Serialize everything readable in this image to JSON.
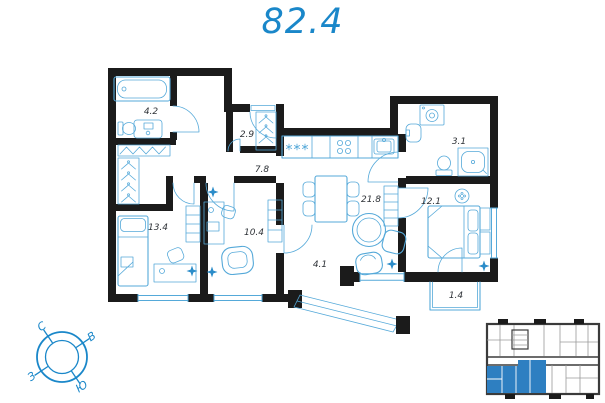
{
  "title": "82.4",
  "colors": {
    "accent": "#1a87c9",
    "furniture_line": "#55a9d9",
    "furniture_accent": "#2b8cc9",
    "wall": "#1b1b1b",
    "minimap_unit": "#2e7fc1"
  },
  "rooms": [
    {
      "id": "bathroom-main",
      "area": "4.2",
      "x": 151,
      "y": 114
    },
    {
      "id": "wardrobe",
      "area": "2.9",
      "x": 247,
      "y": 137
    },
    {
      "id": "hallway",
      "area": "7.8",
      "x": 262,
      "y": 172
    },
    {
      "id": "bedroom-1",
      "area": "13.4",
      "x": 158,
      "y": 230
    },
    {
      "id": "bedroom-2",
      "area": "10.4",
      "x": 254,
      "y": 235
    },
    {
      "id": "kitchen-living",
      "area": "21.8",
      "x": 371,
      "y": 202
    },
    {
      "id": "bathroom-2",
      "area": "3.1",
      "x": 459,
      "y": 144
    },
    {
      "id": "bedroom-3",
      "area": "12.1",
      "x": 431,
      "y": 204
    },
    {
      "id": "entry-hall",
      "area": "4.1",
      "x": 320,
      "y": 267
    },
    {
      "id": "balcony",
      "area": "1.4",
      "x": 456,
      "y": 298
    }
  ],
  "compass": {
    "north": "С",
    "east": "В",
    "west": "З",
    "south": "Ю"
  }
}
